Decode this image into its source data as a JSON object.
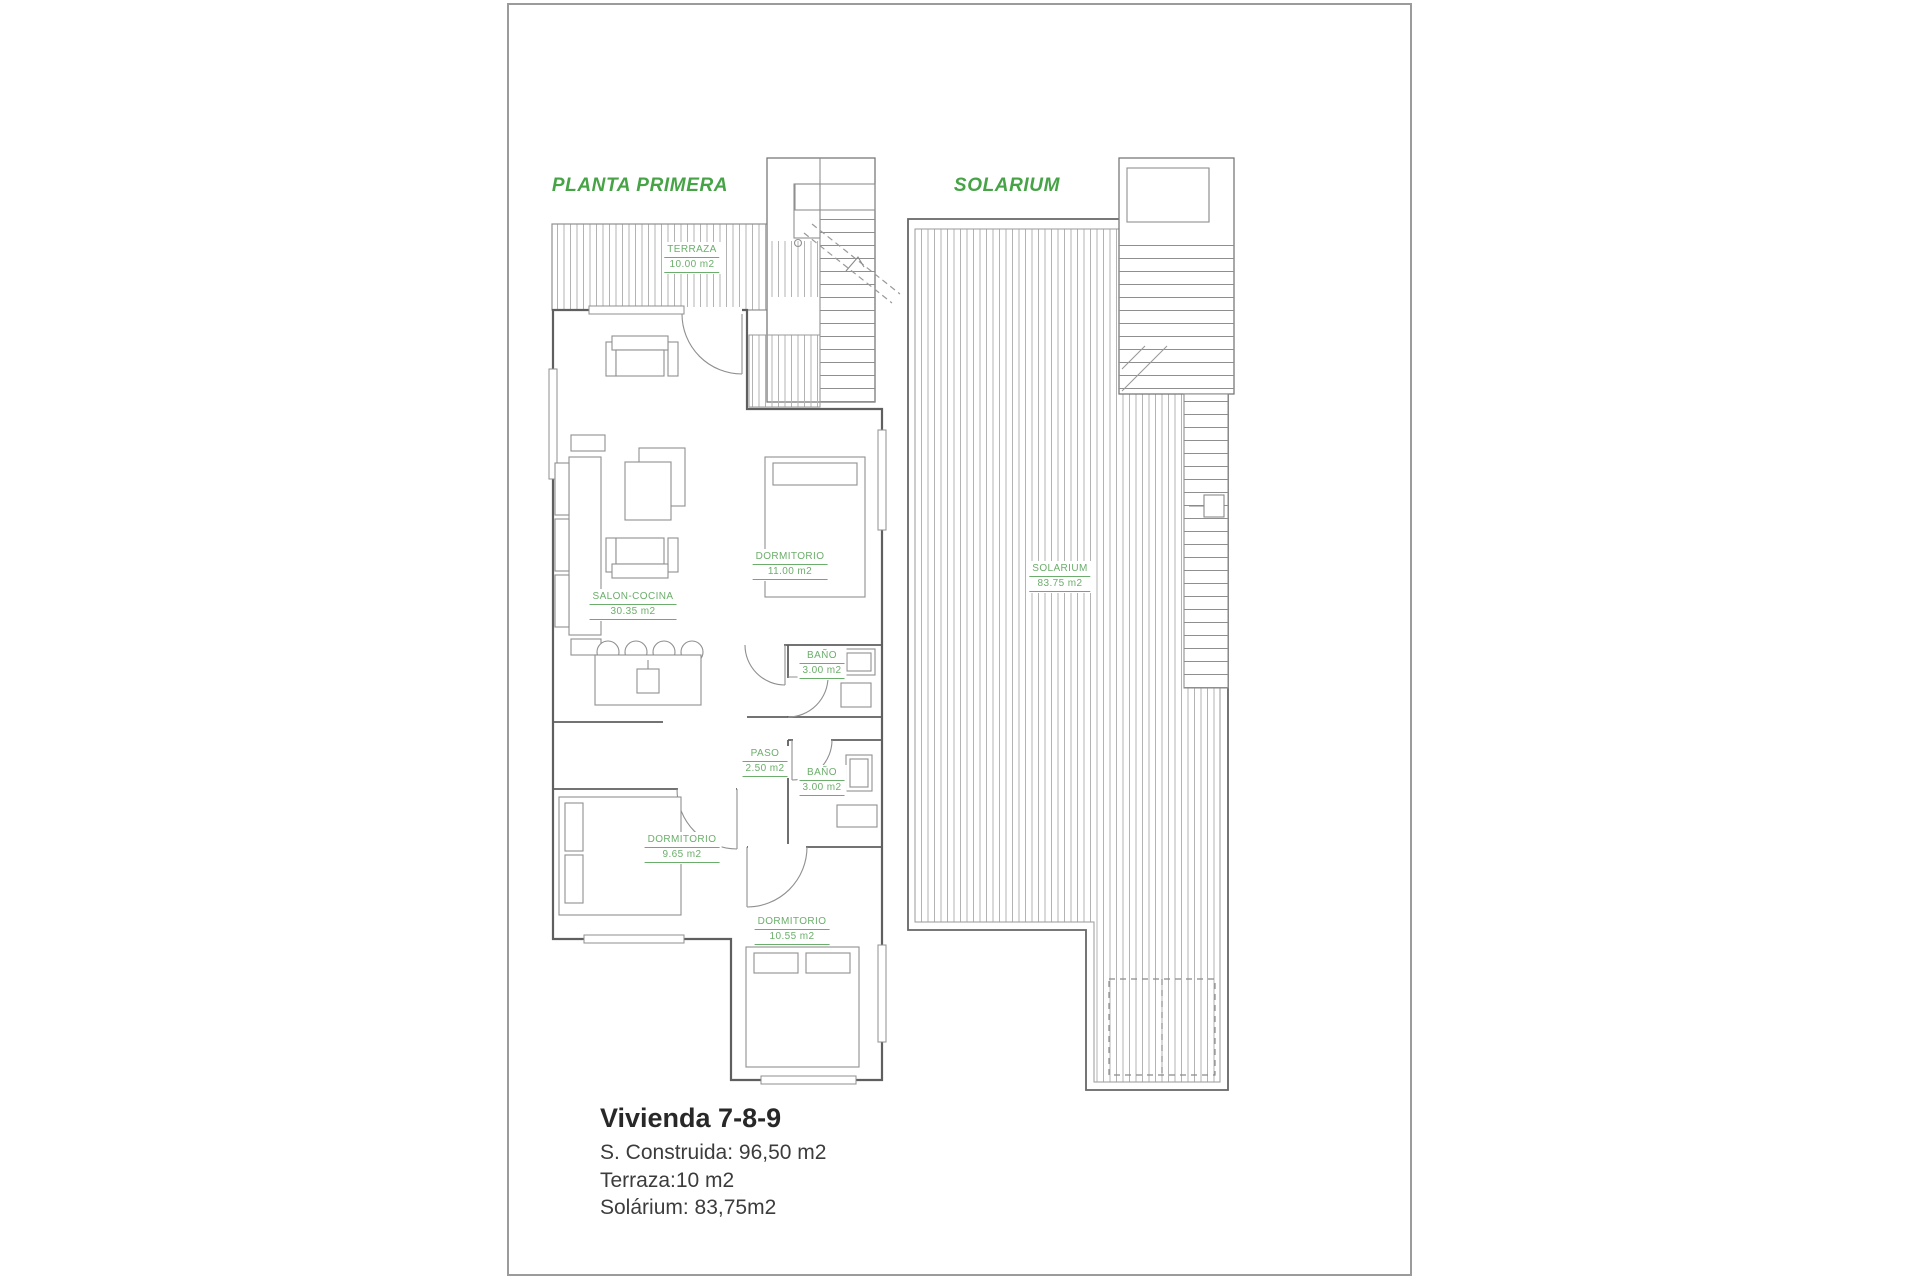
{
  "plans": {
    "planta_primera": {
      "title": "PLANTA PRIMERA",
      "rooms": {
        "terraza": {
          "name": "TERRAZA",
          "area": "10.00 m2"
        },
        "salon_cocina": {
          "name": "SALON-COCINA",
          "area": "30.35 m2"
        },
        "dormitorio_1": {
          "name": "DORMITORIO",
          "area": "11.00 m2"
        },
        "bano_1": {
          "name": "BAÑO",
          "area": "3.00 m2"
        },
        "paso": {
          "name": "PASO",
          "area": "2.50 m2"
        },
        "bano_2": {
          "name": "BAÑO",
          "area": "3.00 m2"
        },
        "dormitorio_2": {
          "name": "DORMITORIO",
          "area": "9.65 m2"
        },
        "dormitorio_3": {
          "name": "DORMITORIO",
          "area": "10.55 m2"
        }
      }
    },
    "solarium": {
      "title": "SOLARIUM",
      "rooms": {
        "solarium": {
          "name": "SOLARIUM",
          "area": "83.75 m2"
        }
      }
    }
  },
  "footer": {
    "title": "Vivienda 7-8-9",
    "lines": [
      "S. Construida: 96,50 m2",
      "Terraza:10 m2",
      "Solárium: 83,75m2"
    ]
  },
  "colors": {
    "title_green": "#46A346",
    "label_green": "#6BAE6B",
    "wall_gray": "#5F5F5F",
    "thin_line_gray": "#8F8F8F",
    "hatch_gray": "#B3B3B3",
    "sheet_border": "#9B9B9B",
    "footer_text": "#3C3C3C"
  }
}
